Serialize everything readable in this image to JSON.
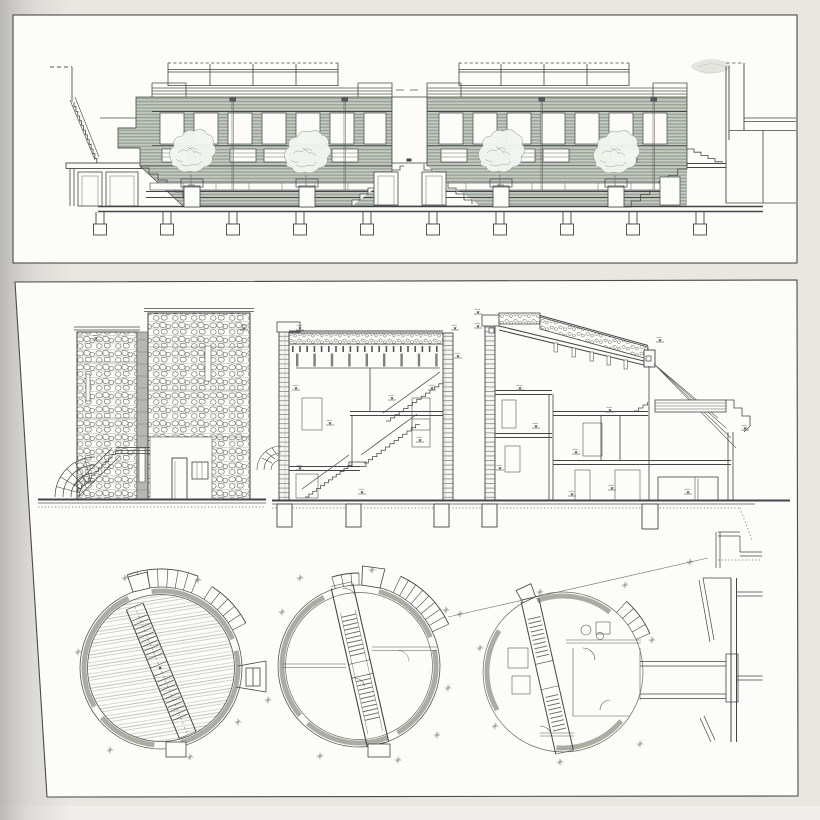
{
  "document": {
    "kind": "scanned architectural drawing plate",
    "panel_count": 2,
    "panels": [
      {
        "id": "top",
        "figure": "building-cross-section-elevation",
        "elements": [
          "roof-terrace-railings",
          "stepped-parapets",
          "clerestory-window-rows",
          "tree-planters",
          "pilotis-and-footings",
          "side-stair",
          "adjacent-building-outline"
        ],
        "tree_count": 4,
        "bay_count": 2,
        "footing_count": 10
      },
      {
        "id": "bottom",
        "figures": [
          "stone-tower-elevation",
          "stair-hall-section",
          "sloped-roof-section",
          "circular-roof-plan",
          "circular-upper-floor-plan",
          "circular-ground-floor-plan",
          "corridor-link-plan-fragment"
        ],
        "circular_plan_count": 3,
        "section_count": 3
      }
    ]
  },
  "palette": {
    "paper": "#e8e7e2",
    "paper_bottom": "#efeeea",
    "gutter": "#b2b1ad",
    "panel": "#fcfcf8",
    "border": "#4a4a48",
    "ink": "#44444a",
    "ink_light": "#85857f",
    "facade_base": "#b4bbb1",
    "facade_line": "#8a948a",
    "facade_hilite": "#d9ded3",
    "gray_band": "#b5b8b0",
    "wall_gray": "#a9ada3",
    "stone_line": "#6b6b66",
    "deck_line": "#98a098",
    "tree_fill": "#f3f5f0",
    "tree_line": "#99a396",
    "smudge": "#b4b4ae"
  },
  "marks": {
    "level_mark_glyph": "level-tick",
    "plus_mark_glyph": "survey-cross"
  }
}
